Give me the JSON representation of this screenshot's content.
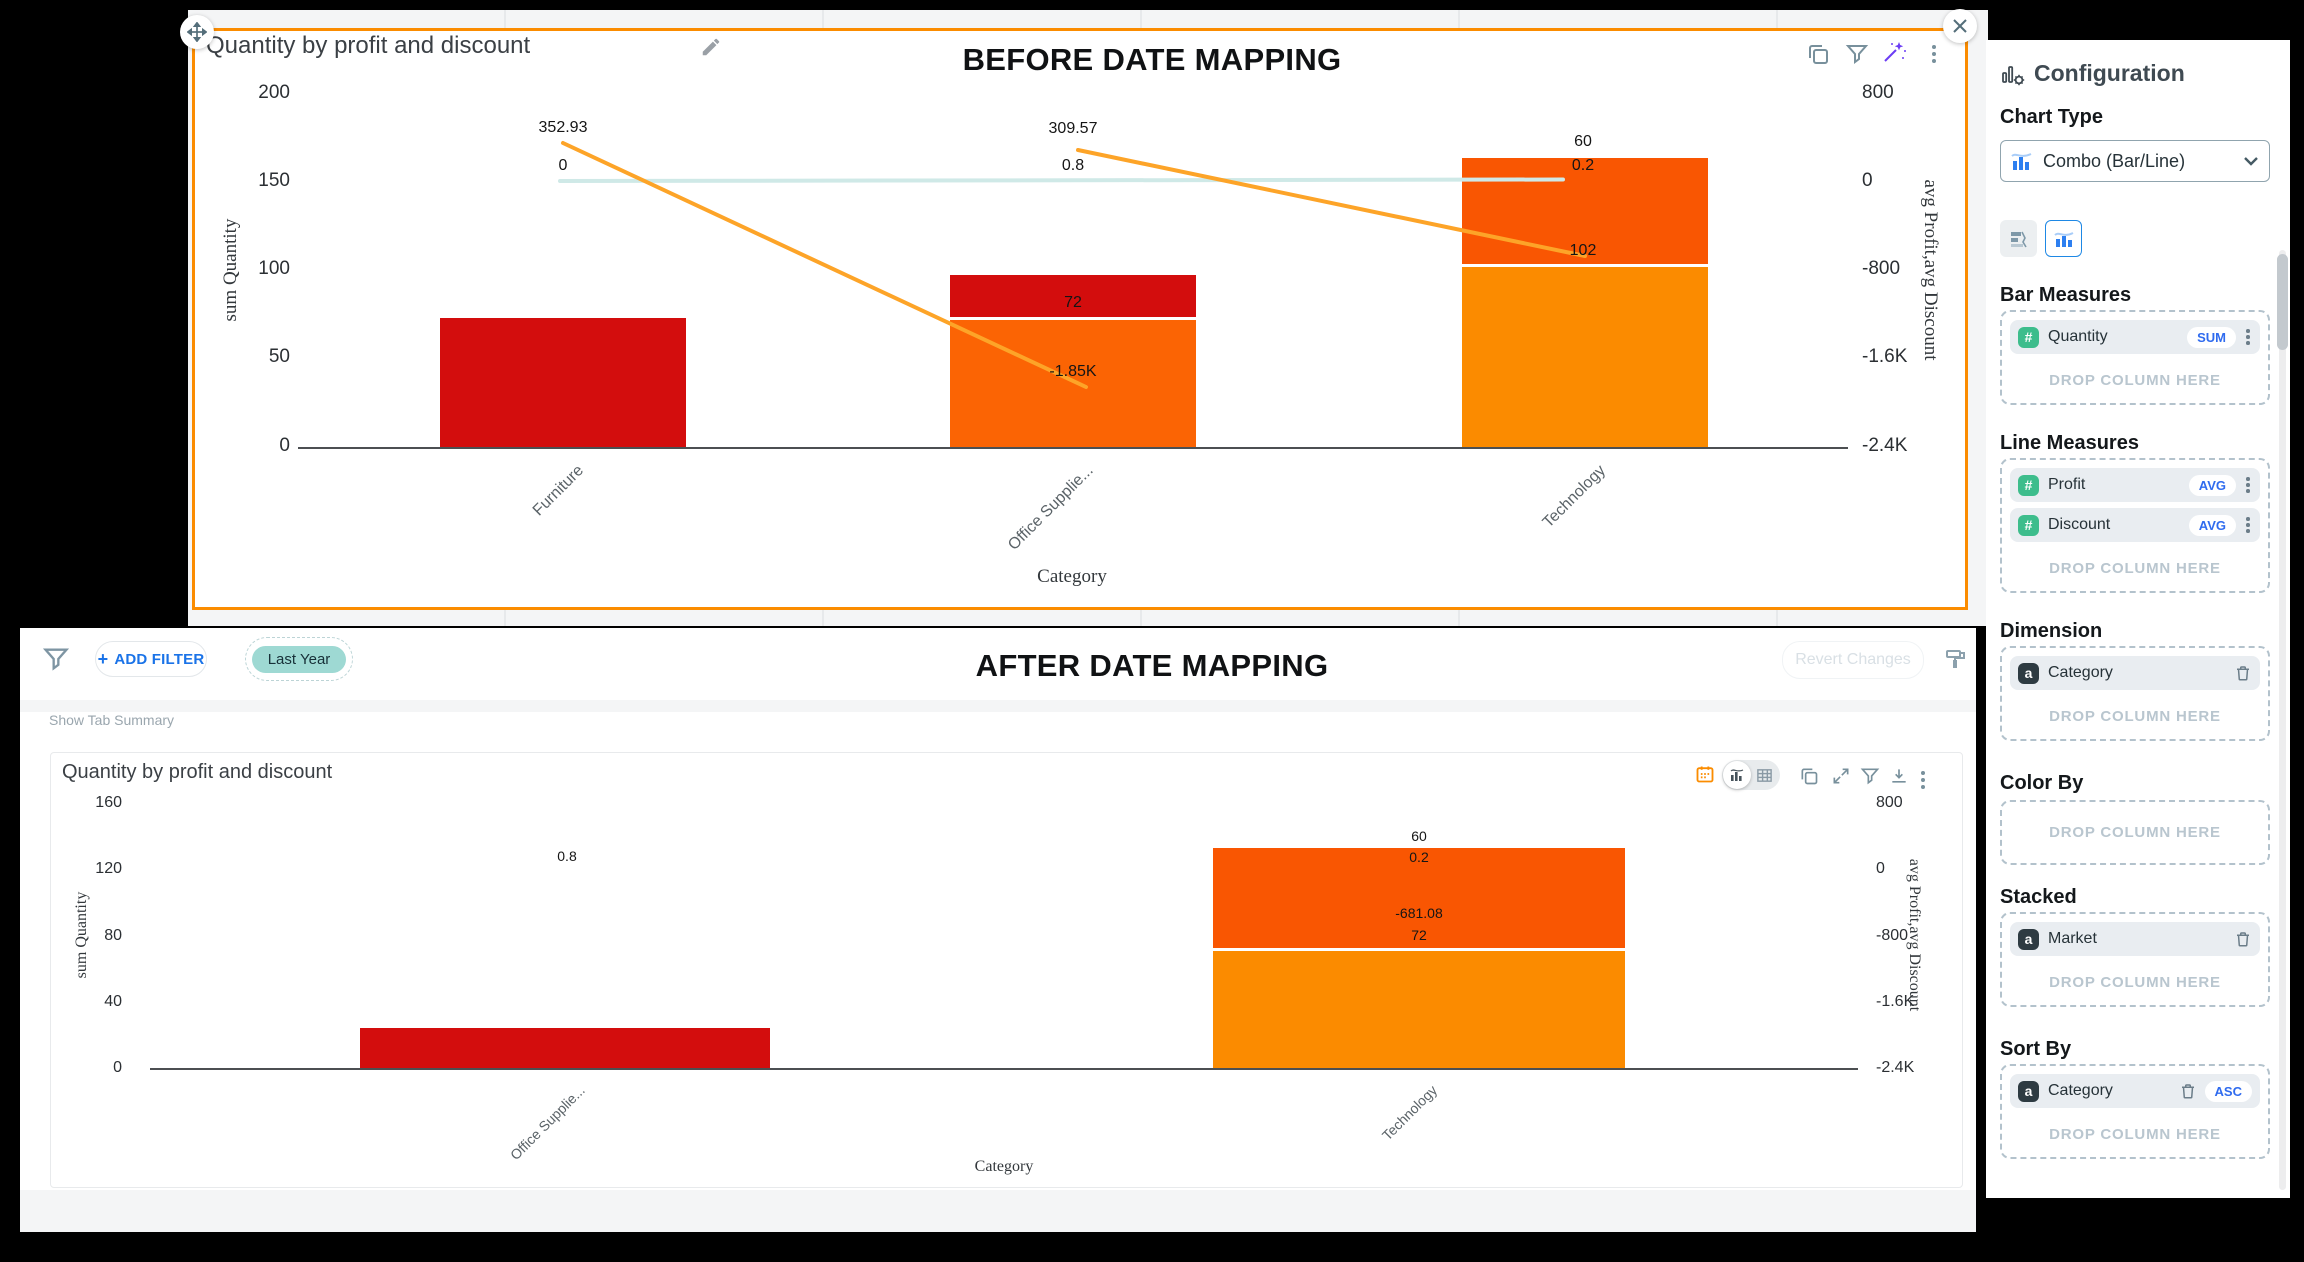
{
  "colors": {
    "selection_orange": "#fb8c00",
    "bar_red": "#d30d0d",
    "bar_orange": "#fb6404",
    "bar_orange_dark": "#f95602",
    "bar_orange_light": "#fb8b00",
    "line_profit": "#fda428",
    "line_discount": "#cfe9e7",
    "chip_teal": "#9ed9d3",
    "link_blue": "#1a73e8",
    "badge_blue": "#2f6bef"
  },
  "before": {
    "title": "Quantity by profit and discount",
    "heading": "BEFORE DATE MAPPING",
    "left_axis": {
      "title": "sum Quantity",
      "ticks": [
        "200",
        "150",
        "100",
        "50",
        "0"
      ]
    },
    "right_axis": {
      "title": "avg Profit,avg Discount",
      "ticks": [
        "800",
        "0",
        "-800",
        "-1.6K",
        "-2.4K"
      ]
    },
    "x_axis": {
      "title": "Category",
      "categories": [
        "Furniture",
        "Office Supplie...",
        "Technology"
      ]
    },
    "labels": {
      "furniture_profit": "352.93",
      "furniture_discount": "0",
      "office_profit": "309.57",
      "office_discount": "0.8",
      "office_qty": "72",
      "office_profit_end": "-1.85K",
      "tech_qty_top": "60",
      "tech_discount": "0.2",
      "tech_qty_bottom": "102"
    },
    "chart_data": {
      "type": "combo-bar-line-stacked",
      "categories": [
        "Furniture",
        "Office Supplie...",
        "Technology"
      ],
      "left_axis": {
        "label": "sum Quantity",
        "ylim": [
          0,
          200
        ]
      },
      "right_axis": {
        "label": "avg Profit,avg Discount",
        "ylim": [
          -2400,
          800
        ]
      },
      "xlabel": "Category",
      "grid": false,
      "stacked_bars": [
        {
          "category": "Furniture",
          "segments": [
            {
              "color_key": "bar_red",
              "value": 73
            }
          ]
        },
        {
          "category": "Office Supplie...",
          "segments": [
            {
              "color_key": "bar_orange",
              "value": 72
            },
            {
              "color_key": "bar_red",
              "value": 24
            }
          ]
        },
        {
          "category": "Technology",
          "segments": [
            {
              "color_key": "bar_orange_light",
              "value": 102
            },
            {
              "color_key": "bar_orange_dark",
              "value": 60
            }
          ]
        }
      ],
      "lines": [
        {
          "series": "avg Profit",
          "color_key": "line_profit",
          "points": [
            [
              "Furniture",
              352.93
            ],
            [
              "Office Supplie...",
              -1850
            ]
          ]
        },
        {
          "series": "avg Profit",
          "color_key": "line_profit",
          "points": [
            [
              "Office Supplie...",
              309.57
            ],
            [
              "Technology",
              -681.08
            ]
          ]
        },
        {
          "series": "avg Discount",
          "color_key": "line_discount",
          "points": [
            [
              "Furniture",
              0
            ],
            [
              "Office Supplie...",
              0.8
            ],
            [
              "Technology",
              0.2
            ]
          ]
        }
      ]
    }
  },
  "after": {
    "heading": "AFTER DATE MAPPING",
    "filter_bar": {
      "add_filter": "ADD FILTER",
      "plus": "+",
      "chip": "Last Year",
      "revert": "Revert Changes"
    },
    "show_tab_summary": "Show Tab Summary",
    "card_title": "Quantity by profit and discount",
    "left_axis": {
      "title": "sum Quantity",
      "ticks": [
        "160",
        "120",
        "80",
        "40",
        "0"
      ]
    },
    "right_axis": {
      "title": "avg Profit,avg Discount",
      "ticks": [
        "800",
        "0",
        "-800",
        "-1.6K",
        "-2.4K"
      ]
    },
    "x_axis": {
      "title": "Category",
      "categories": [
        "Office Supplie...",
        "Technology"
      ]
    },
    "labels": {
      "office_discount": "0.8",
      "tech_qty_top": "60",
      "tech_discount": "0.2",
      "tech_profit": "-681.08",
      "tech_qty_bottom": "72"
    },
    "chart_data": {
      "type": "combo-bar-line-stacked",
      "categories": [
        "Office Supplie...",
        "Technology"
      ],
      "left_axis": {
        "label": "sum Quantity",
        "ylim": [
          0,
          160
        ]
      },
      "right_axis": {
        "label": "avg Profit,avg Discount",
        "ylim": [
          -2400,
          800
        ]
      },
      "xlabel": "Category",
      "grid": false,
      "stacked_bars": [
        {
          "category": "Office Supplie...",
          "segments": [
            {
              "color_key": "bar_red",
              "value": 25
            }
          ],
          "avg_discount": 0.8
        },
        {
          "category": "Technology",
          "segments": [
            {
              "color_key": "bar_orange_light",
              "value": 72
            },
            {
              "color_key": "bar_orange_dark",
              "value": 60
            }
          ],
          "avg_discount": 0.2,
          "avg_profit": -681.08
        }
      ]
    }
  },
  "config": {
    "title": "Configuration",
    "chart_type_label": "Chart Type",
    "chart_type_value": "Combo (Bar/Line)",
    "drop_hint": "DROP COLUMN HERE",
    "bar_measures": {
      "label": "Bar Measures",
      "pills": [
        {
          "badge": "#",
          "name": "Quantity",
          "agg": "SUM"
        }
      ]
    },
    "line_measures": {
      "label": "Line Measures",
      "pills": [
        {
          "badge": "#",
          "name": "Profit",
          "agg": "AVG"
        },
        {
          "badge": "#",
          "name": "Discount",
          "agg": "AVG"
        }
      ]
    },
    "dimension": {
      "label": "Dimension",
      "pills": [
        {
          "badge": "a",
          "name": "Category"
        }
      ]
    },
    "color_by": {
      "label": "Color By"
    },
    "stacked": {
      "label": "Stacked",
      "pills": [
        {
          "badge": "a",
          "name": "Market"
        }
      ]
    },
    "sort_by": {
      "label": "Sort By",
      "pills": [
        {
          "badge": "a",
          "name": "Category",
          "agg": "ASC"
        }
      ]
    }
  }
}
